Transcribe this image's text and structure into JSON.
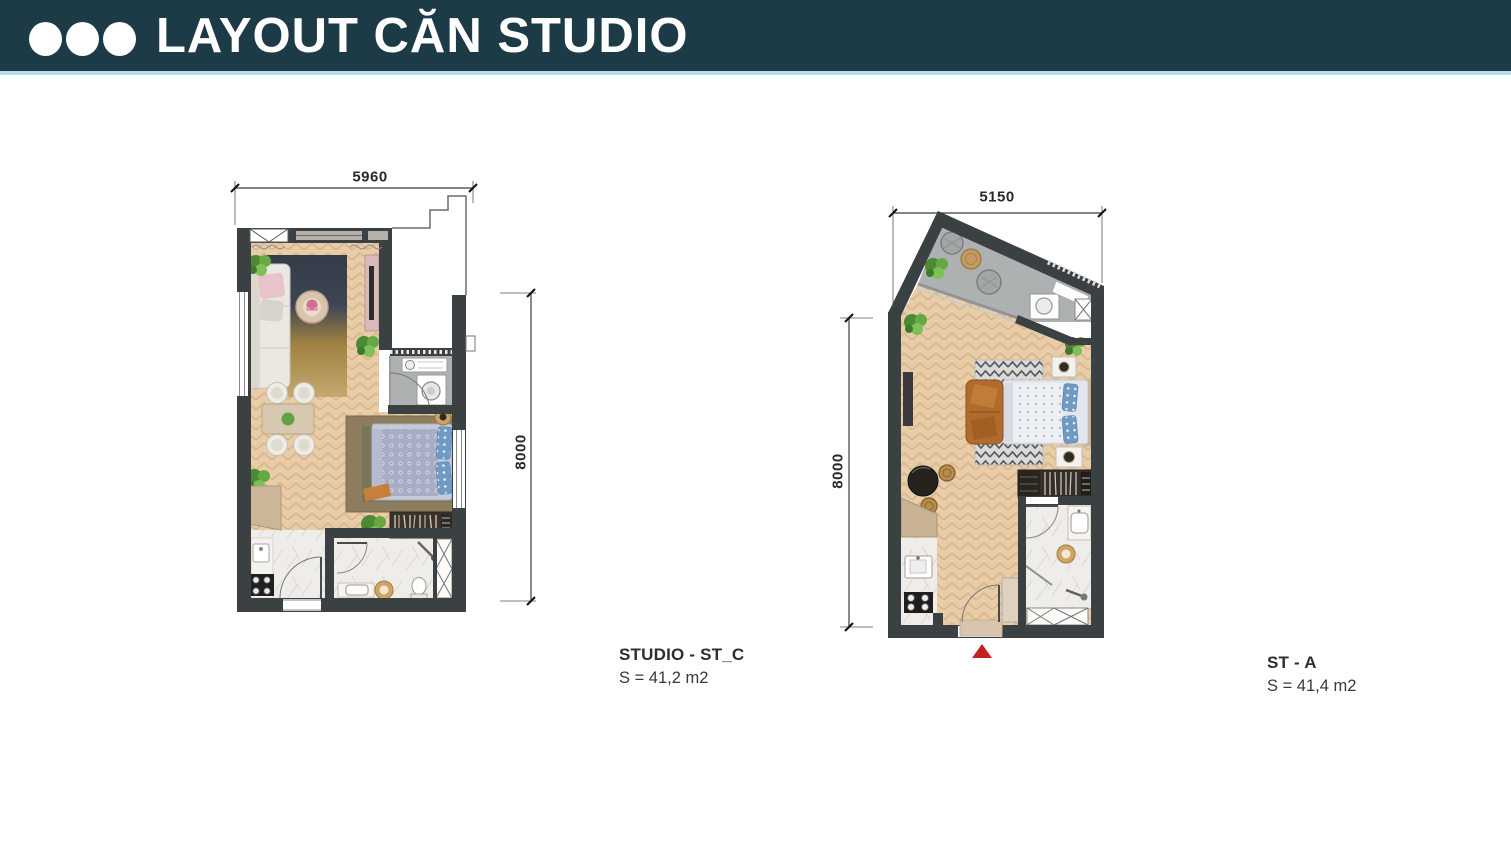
{
  "header": {
    "title": "LAYOUT CĂN STUDIO",
    "dot_count": 3,
    "background_color": "#1d3a47",
    "accent_line_color": "#b7dbe7"
  },
  "plans": [
    {
      "id": "st-c",
      "name": "STUDIO - ST_C",
      "area": "S = 41,2 m2",
      "width_dim": "5960",
      "height_dim": "8000"
    },
    {
      "id": "st-a",
      "name": "ST - A",
      "area": "S = 41,4 m2",
      "width_dim": "5150",
      "height_dim": "8000"
    }
  ],
  "colors": {
    "wall": "#3b4043",
    "wood_floor": "#e9cda9",
    "balcony_floor": "#aeb1b2",
    "marble_floor": "#efedea",
    "entrance_marker": "#c32222"
  }
}
